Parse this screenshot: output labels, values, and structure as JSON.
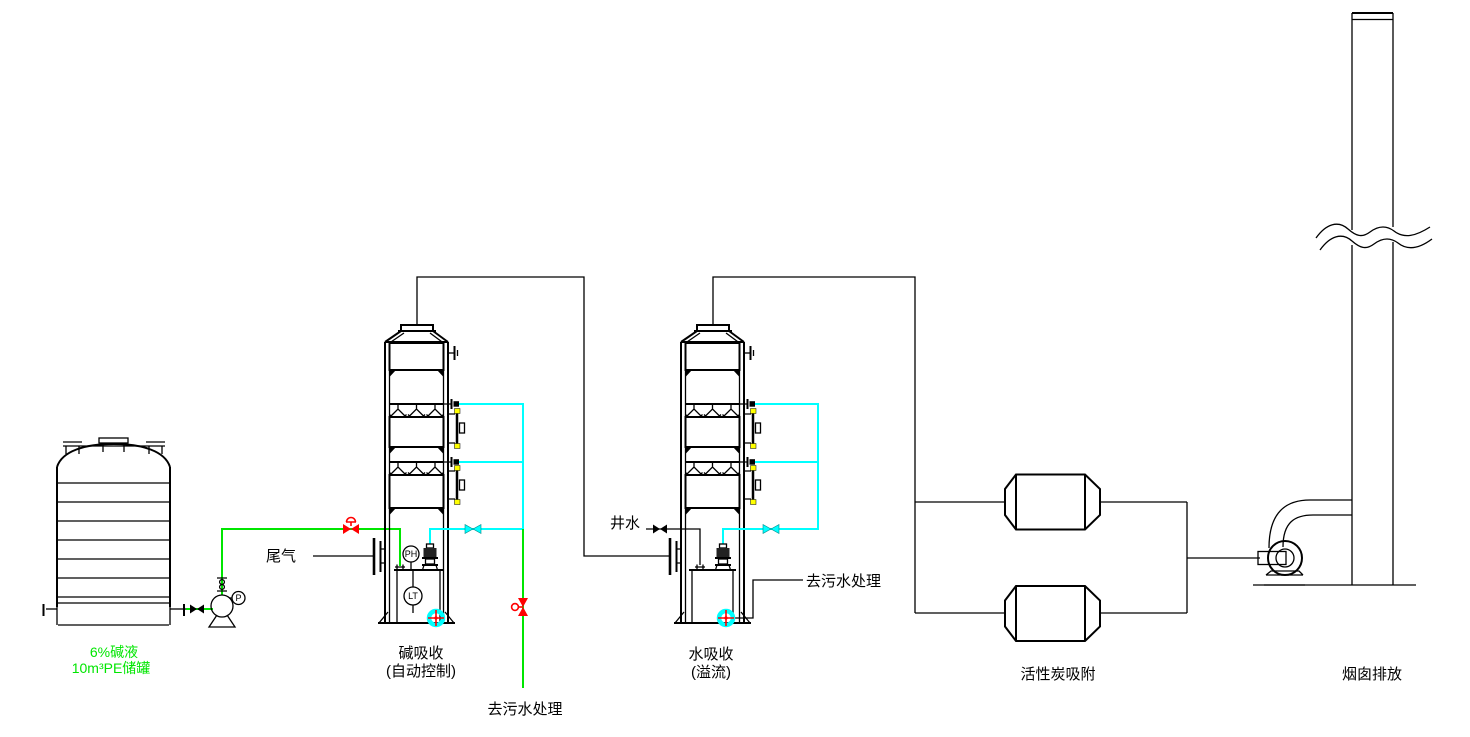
{
  "diagram_type": "waste-gas-treatment-process-flow",
  "colors": {
    "background": "#ffffff",
    "line_black": "#000000",
    "line_green": "#00e600",
    "line_cyan": "#00ffff",
    "valve_red": "#ff0000",
    "accent_yellow": "#ffff00"
  },
  "labels": {
    "tank_line1": "6%碱液",
    "tank_line2": "10m³PE储罐",
    "tail_gas": "尾气",
    "tower1_name": "碱吸收",
    "tower1_mode": "(自动控制)",
    "drain1": "去污水处理",
    "well_water": "井水",
    "tower2_name": "水吸收",
    "tower2_mode": "(溢流)",
    "drain2": "去污水处理",
    "carbon_unit": "活性炭吸附",
    "stack": "烟囱排放",
    "ph_meter": "PH",
    "level_meter": "LT",
    "pressure_gauge": "P"
  }
}
